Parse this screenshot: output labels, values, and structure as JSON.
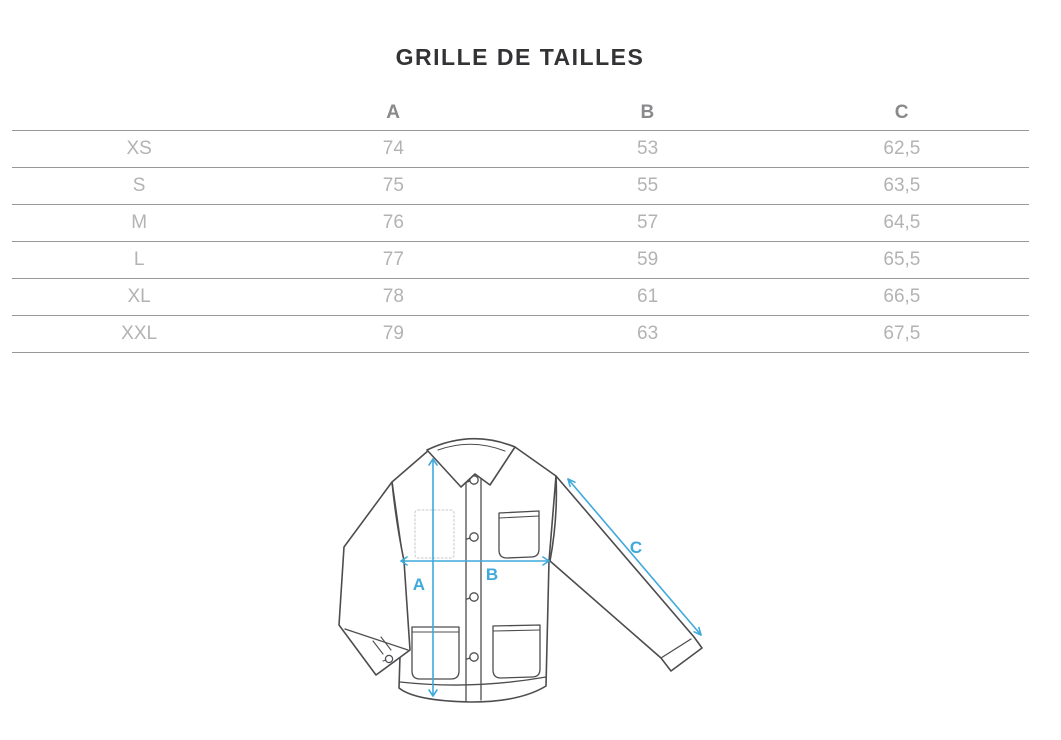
{
  "page": {
    "title": "GRILLE DE TAILLES"
  },
  "table": {
    "headers": [
      "",
      "A",
      "B",
      "C"
    ],
    "rows": [
      [
        "XS",
        "74",
        "53",
        "62,5"
      ],
      [
        "S",
        "75",
        "55",
        "63,5"
      ],
      [
        "M",
        "76",
        "57",
        "64,5"
      ],
      [
        "L",
        "77",
        "59",
        "65,5"
      ],
      [
        "XL",
        "78",
        "61",
        "66,5"
      ],
      [
        "XXL",
        "79",
        "63",
        "67,5"
      ]
    ]
  },
  "diagram": {
    "measure_labels": {
      "a": "A",
      "b": "B",
      "c": "C"
    },
    "accent_color": "#3FA9DC",
    "line_color": "#4D4D50"
  }
}
